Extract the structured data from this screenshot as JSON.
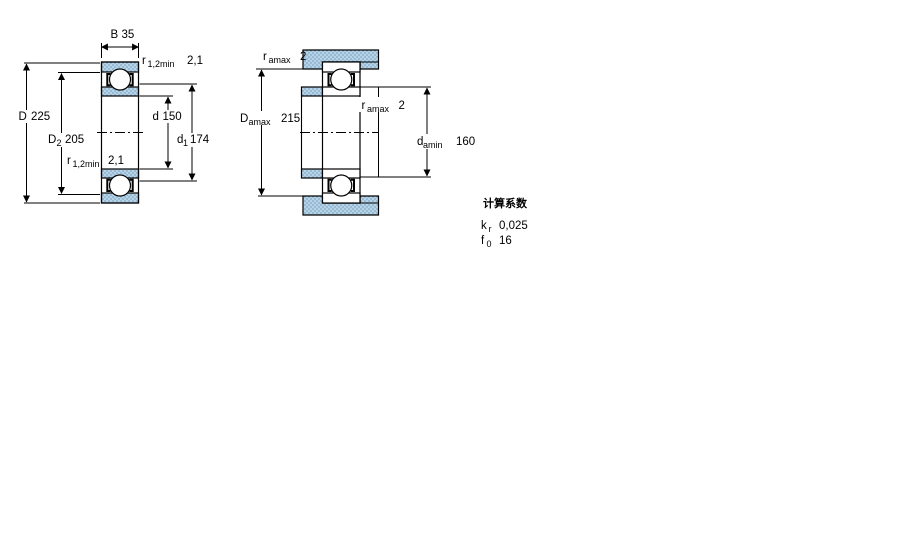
{
  "colors": {
    "steel_base": "#b9d3e6",
    "steel_dot": "#7fa9c9",
    "line": "#000000",
    "background": "#ffffff"
  },
  "figure_left": {
    "name": "bearing cross-section",
    "dims": {
      "B": {
        "sym": "B",
        "sub": "",
        "val": "35"
      },
      "r_top": {
        "sym": "r",
        "sub": "1,2min",
        "val": "2,1"
      },
      "D": {
        "sym": "D",
        "sub": "",
        "val": "225"
      },
      "D2": {
        "sym": "D",
        "sub": "2",
        "val": "205"
      },
      "d": {
        "sym": "d",
        "sub": "",
        "val": "150"
      },
      "d1": {
        "sym": "d",
        "sub": "1",
        "val": "174"
      },
      "r_bottom": {
        "sym": "r",
        "sub": "1,2min",
        "val": "2,1"
      }
    }
  },
  "figure_right": {
    "name": "abutment / mounting dimensions",
    "dims": {
      "ra_housing": {
        "sym": "r",
        "sub": "amax",
        "val": "2"
      },
      "Damax": {
        "sym": "D",
        "sub": "amax",
        "val": "215"
      },
      "ra_shaft": {
        "sym": "r",
        "sub": "amax",
        "val": "2"
      },
      "damin": {
        "sym": "d",
        "sub": "amin",
        "val": "160"
      }
    }
  },
  "calc": {
    "heading": "计算系数",
    "rows": [
      {
        "sym": "k",
        "sub": "r",
        "val": "0,025"
      },
      {
        "sym": "f",
        "sub": "0",
        "val": "16"
      }
    ]
  }
}
